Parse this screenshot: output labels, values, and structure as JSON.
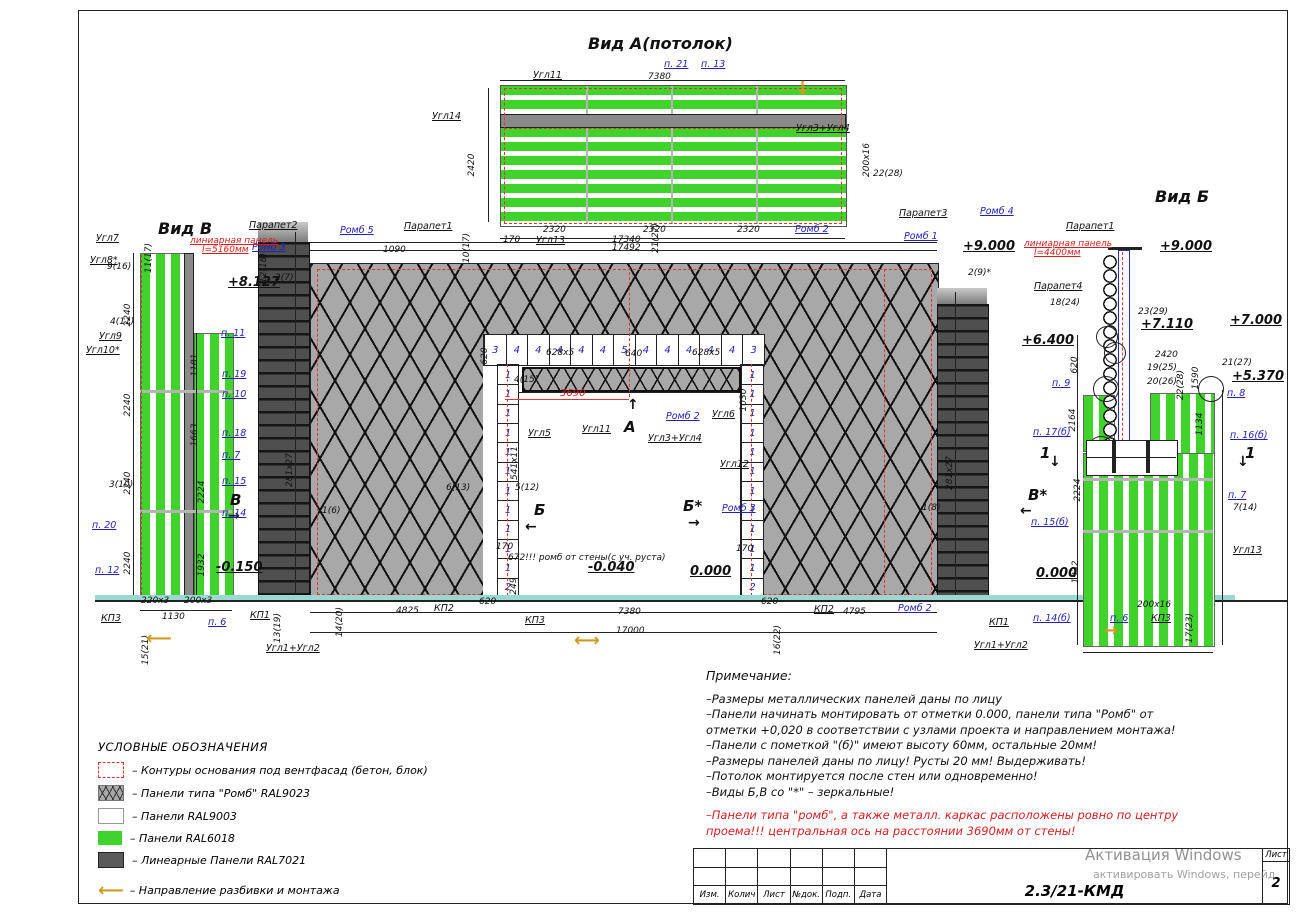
{
  "colors": {
    "green_ral6018": "#3fd32c",
    "gray_ral9023": "#a8a8a8",
    "white_ral9003": "#ffffff",
    "linear_ral7021": "#4f4f4f",
    "contour_red": "#e03535",
    "label_blue": "#2222bb",
    "arrow_orange": "#cf9a20"
  },
  "views": {
    "top_title": "Вид А(потолок)",
    "left_title": "Вид В",
    "right_title": "Вид Б"
  },
  "opening": {
    "top_row": [
      "3",
      "4",
      "4",
      "4",
      "4",
      "4",
      "5",
      "4",
      "4",
      "4",
      "4",
      "4",
      "3"
    ],
    "left_col": [
      "1",
      "1",
      "1",
      "1",
      "1",
      "1",
      "1",
      "1",
      "1",
      "1",
      "1",
      "2"
    ],
    "right_col": [
      "1",
      "1",
      "1",
      "1",
      "1",
      "1",
      "1",
      "1",
      "1",
      "1",
      "1",
      "2"
    ]
  },
  "legend": {
    "title": "УСЛОВНЫЕ ОБОЗНАЧЕНИЯ",
    "items": [
      {
        "swatch": "base",
        "label": "– Контуры основания под вентфасад (бетон, блок)"
      },
      {
        "swatch": "rhomb",
        "label": "– Панели типа \"Ромб\" RAL9023"
      },
      {
        "swatch": "white",
        "label": "– Панели  RAL9003"
      },
      {
        "swatch": "green",
        "label": "– Панели  RAL6018"
      },
      {
        "swatch": "linear",
        "label": "– Линеарные Панели RAL7021"
      }
    ],
    "direction_arrow": "⟵",
    "direction_label": "– Направление разбивки и монтажа"
  },
  "notes": {
    "title": "Примечание:",
    "lines": [
      "–Размеры металлических панелей даны по лицу",
      "–Панели начинать монтировать от отметки 0.000, панели типа \"Ромб\" от",
      "отметки +0,020 в соответствии с узлами проекта и направлением монтажа!",
      "–Панели с пометкой \"(б)\" имеют высоту 60мм, остальные 20мм!",
      "–Размеры панелей даны по лицу! Русты 20 мм! Выдерживать!",
      "–Потолок монтируется после стен или одновременно!",
      "–Виды Б,В со \"*\" – зеркальные!"
    ],
    "red_lines": [
      "–Панели типа \"ромб\", а также металл. каркас расположены ровно по центру",
      "проема!!! центральная ось на расстоянии 3690мм от стены!"
    ]
  },
  "titleblock": {
    "cols": [
      "Изм.",
      "Колич",
      "Лист",
      "№док.",
      "Подп.",
      "Дата"
    ],
    "code": "2.3/21-КМД",
    "sheet_label": "Лист",
    "sheet_num": "2"
  },
  "watermark": {
    "line1": "Активация Windows",
    "line2": "активировать Windows, перейд"
  },
  "annotations": [
    {
      "t": "Вид А(потолок)",
      "x": 588,
      "y": 36,
      "c": "t"
    },
    {
      "t": "Угл11",
      "x": 533,
      "y": 71,
      "c": "k"
    },
    {
      "t": "7380",
      "x": 648,
      "y": 73,
      "c": "d"
    },
    {
      "t": "п. 21",
      "x": 664,
      "y": 60,
      "c": "b"
    },
    {
      "t": "п. 13",
      "x": 701,
      "y": 60,
      "c": "b"
    },
    {
      "t": "↓",
      "x": 795,
      "y": 80,
      "c": "o"
    },
    {
      "t": "Угл14",
      "x": 432,
      "y": 112,
      "c": "k"
    },
    {
      "t": "Угл3+Угл4",
      "x": 796,
      "y": 124,
      "c": "k"
    },
    {
      "t": "2420",
      "x": 468,
      "y": 165,
      "c": "dv"
    },
    {
      "t": "200x16",
      "x": 863,
      "y": 160,
      "c": "dv"
    },
    {
      "t": "22(28)",
      "x": 873,
      "y": 170,
      "c": "d"
    },
    {
      "t": "170",
      "x": 503,
      "y": 236,
      "c": "d"
    },
    {
      "t": "2320",
      "x": 543,
      "y": 226,
      "c": "d"
    },
    {
      "t": "Угл13",
      "x": 536,
      "y": 236,
      "c": "k"
    },
    {
      "t": "2320",
      "x": 643,
      "y": 226,
      "c": "d"
    },
    {
      "t": "21(27)",
      "x": 652,
      "y": 238,
      "c": "dv"
    },
    {
      "t": "2320",
      "x": 737,
      "y": 226,
      "c": "d"
    },
    {
      "t": "17340",
      "x": 612,
      "y": 236,
      "c": "d"
    },
    {
      "t": "17492",
      "x": 612,
      "y": 244,
      "c": "d"
    },
    {
      "t": "Парапет2",
      "x": 249,
      "y": 221,
      "c": "k"
    },
    {
      "t": "Ромб 5",
      "x": 340,
      "y": 226,
      "c": "b"
    },
    {
      "t": "Парапет1",
      "x": 404,
      "y": 222,
      "c": "k"
    },
    {
      "t": "Ромб 3",
      "x": 252,
      "y": 243,
      "c": "b"
    },
    {
      "t": "линиарная панель",
      "x": 190,
      "y": 237,
      "c": "r"
    },
    {
      "t": "l=5160мм",
      "x": 202,
      "y": 246,
      "c": "r"
    },
    {
      "t": "+8.127",
      "x": 228,
      "y": 276,
      "c": "lv"
    },
    {
      "t": "12(18)",
      "x": 260,
      "y": 268,
      "c": "dv"
    },
    {
      "t": "2(7)",
      "x": 275,
      "y": 274,
      "c": "d"
    },
    {
      "t": "1090",
      "x": 383,
      "y": 246,
      "c": "d"
    },
    {
      "t": "10(17)",
      "x": 463,
      "y": 248,
      "c": "dv"
    },
    {
      "t": "Ромб 2",
      "x": 795,
      "y": 225,
      "c": "b"
    },
    {
      "t": "Парапет3",
      "x": 899,
      "y": 209,
      "c": "k"
    },
    {
      "t": "Ромб 4",
      "x": 980,
      "y": 207,
      "c": "b"
    },
    {
      "t": "Ромб 1",
      "x": 904,
      "y": 232,
      "c": "b"
    },
    {
      "t": "+9.000",
      "x": 963,
      "y": 240,
      "c": "lv"
    },
    {
      "t": "2(9)*",
      "x": 968,
      "y": 269,
      "c": "d"
    },
    {
      "t": "линиарная панель",
      "x": 1024,
      "y": 240,
      "c": "r"
    },
    {
      "t": "l=4400мм",
      "x": 1034,
      "y": 249,
      "c": "r"
    },
    {
      "t": "620",
      "x": 481,
      "y": 356,
      "c": "dv"
    },
    {
      "t": "628x5",
      "x": 546,
      "y": 349,
      "c": "d"
    },
    {
      "t": "640",
      "x": 625,
      "y": 350,
      "c": "d"
    },
    {
      "t": "628x5",
      "x": 692,
      "y": 349,
      "c": "d"
    },
    {
      "t": "4(15)",
      "x": 514,
      "y": 376,
      "c": "d"
    },
    {
      "t": "3690",
      "x": 560,
      "y": 389,
      "c": "rd"
    },
    {
      "t": "Ромб 2",
      "x": 666,
      "y": 412,
      "c": "b"
    },
    {
      "t": "Угл6",
      "x": 712,
      "y": 410,
      "c": "k"
    },
    {
      "t": "1030",
      "x": 740,
      "y": 400,
      "c": "dv"
    },
    {
      "t": "↑",
      "x": 627,
      "y": 398,
      "c": "arr"
    },
    {
      "t": "А",
      "x": 624,
      "y": 420,
      "c": "big"
    },
    {
      "t": "Угл11",
      "x": 582,
      "y": 425,
      "c": "k"
    },
    {
      "t": "Угл3+Угл4",
      "x": 648,
      "y": 434,
      "c": "k"
    },
    {
      "t": "Угл5",
      "x": 528,
      "y": 429,
      "c": "k"
    },
    {
      "t": "541x11",
      "x": 511,
      "y": 463,
      "c": "dv"
    },
    {
      "t": "5(12)",
      "x": 515,
      "y": 484,
      "c": "d"
    },
    {
      "t": "Б",
      "x": 534,
      "y": 503,
      "c": "big"
    },
    {
      "t": "←",
      "x": 525,
      "y": 520,
      "c": "arr"
    },
    {
      "t": "Б*",
      "x": 683,
      "y": 499,
      "c": "big"
    },
    {
      "t": "→",
      "x": 688,
      "y": 516,
      "c": "arr"
    },
    {
      "t": "Угл12",
      "x": 720,
      "y": 460,
      "c": "k"
    },
    {
      "t": "Ромб 3",
      "x": 722,
      "y": 504,
      "c": "b"
    },
    {
      "t": "6(13)",
      "x": 446,
      "y": 484,
      "c": "d"
    },
    {
      "t": "1(6)",
      "x": 322,
      "y": 507,
      "c": "d"
    },
    {
      "t": "1(8)",
      "x": 922,
      "y": 504,
      "c": "d"
    },
    {
      "t": "281x27",
      "x": 286,
      "y": 470,
      "c": "dv"
    },
    {
      "t": "281x27",
      "x": 946,
      "y": 473,
      "c": "dv"
    },
    {
      "t": "170",
      "x": 496,
      "y": 543,
      "c": "d"
    },
    {
      "t": "170",
      "x": 736,
      "y": 545,
      "c": "d"
    },
    {
      "t": "672!!! ромб от стены(с уч. руста)",
      "x": 508,
      "y": 554,
      "c": "d"
    },
    {
      "t": "-0.040",
      "x": 588,
      "y": 561,
      "c": "lv"
    },
    {
      "t": "0.000",
      "x": 690,
      "y": 565,
      "c": "lv"
    },
    {
      "t": "249",
      "x": 510,
      "y": 586,
      "c": "dv"
    },
    {
      "t": "-0.150",
      "x": 216,
      "y": 561,
      "c": "lv"
    },
    {
      "t": "14(20)",
      "x": 336,
      "y": 622,
      "c": "dv"
    },
    {
      "t": "4825",
      "x": 396,
      "y": 607,
      "c": "d"
    },
    {
      "t": "КП2",
      "x": 434,
      "y": 604,
      "c": "k"
    },
    {
      "t": "620",
      "x": 479,
      "y": 598,
      "c": "d"
    },
    {
      "t": "КП3",
      "x": 525,
      "y": 616,
      "c": "k"
    },
    {
      "t": "7380",
      "x": 618,
      "y": 608,
      "c": "d"
    },
    {
      "t": "17000",
      "x": 616,
      "y": 627,
      "c": "d"
    },
    {
      "t": "⟷",
      "x": 574,
      "y": 632,
      "c": "o"
    },
    {
      "t": "620",
      "x": 761,
      "y": 598,
      "c": "d"
    },
    {
      "t": "16(22)",
      "x": 774,
      "y": 640,
      "c": "dv"
    },
    {
      "t": "КП2",
      "x": 814,
      "y": 605,
      "c": "k"
    },
    {
      "t": "4795",
      "x": 843,
      "y": 608,
      "c": "d"
    },
    {
      "t": "Ромб 2",
      "x": 898,
      "y": 604,
      "c": "b"
    },
    {
      "t": "КП1",
      "x": 989,
      "y": 618,
      "c": "k"
    },
    {
      "t": "Угл1+Угл2",
      "x": 974,
      "y": 641,
      "c": "k"
    },
    {
      "t": "Вид В",
      "x": 158,
      "y": 221,
      "c": "t"
    },
    {
      "t": "Угл7",
      "x": 96,
      "y": 234,
      "c": "k"
    },
    {
      "t": "11(17)",
      "x": 145,
      "y": 258,
      "c": "dv"
    },
    {
      "t": "Угл8*",
      "x": 90,
      "y": 256,
      "c": "k"
    },
    {
      "t": "9(16)",
      "x": 107,
      "y": 263,
      "c": "d"
    },
    {
      "t": "2240",
      "x": 124,
      "y": 315,
      "c": "dv"
    },
    {
      "t": "4(11)",
      "x": 110,
      "y": 318,
      "c": "d"
    },
    {
      "t": "Угл9",
      "x": 99,
      "y": 332,
      "c": "k"
    },
    {
      "t": "Угл10*",
      "x": 86,
      "y": 346,
      "c": "k"
    },
    {
      "t": "2240",
      "x": 124,
      "y": 405,
      "c": "dv"
    },
    {
      "t": "2240",
      "x": 124,
      "y": 483,
      "c": "dv"
    },
    {
      "t": "2240",
      "x": 124,
      "y": 563,
      "c": "dv"
    },
    {
      "t": "3(10)",
      "x": 109,
      "y": 481,
      "c": "d"
    },
    {
      "t": "п. 20",
      "x": 92,
      "y": 521,
      "c": "b"
    },
    {
      "t": "п. 12",
      "x": 95,
      "y": 566,
      "c": "b"
    },
    {
      "t": "п. 11",
      "x": 221,
      "y": 329,
      "c": "b"
    },
    {
      "t": "1181",
      "x": 191,
      "y": 365,
      "c": "dv"
    },
    {
      "t": "п. 19",
      "x": 222,
      "y": 370,
      "c": "b"
    },
    {
      "t": "п. 10",
      "x": 222,
      "y": 390,
      "c": "b"
    },
    {
      "t": "1663",
      "x": 191,
      "y": 435,
      "c": "dv"
    },
    {
      "t": "п. 18",
      "x": 222,
      "y": 429,
      "c": "b"
    },
    {
      "t": "п. 7",
      "x": 222,
      "y": 451,
      "c": "b"
    },
    {
      "t": "2224",
      "x": 198,
      "y": 492,
      "c": "dv"
    },
    {
      "t": "п. 15",
      "x": 222,
      "y": 477,
      "c": "b"
    },
    {
      "t": "B",
      "x": 230,
      "y": 493,
      "c": "big"
    },
    {
      "t": "→",
      "x": 228,
      "y": 509,
      "c": "arr"
    },
    {
      "t": "п. 14",
      "x": 222,
      "y": 509,
      "c": "b"
    },
    {
      "t": "1932",
      "x": 198,
      "y": 565,
      "c": "dv"
    },
    {
      "t": "КП3",
      "x": 101,
      "y": 614,
      "c": "k"
    },
    {
      "t": "220x3",
      "x": 141,
      "y": 597,
      "c": "d"
    },
    {
      "t": "200x3",
      "x": 184,
      "y": 597,
      "c": "d"
    },
    {
      "t": "1130",
      "x": 162,
      "y": 613,
      "c": "d"
    },
    {
      "t": "15(21)",
      "x": 142,
      "y": 650,
      "c": "dv"
    },
    {
      "t": "⟵",
      "x": 146,
      "y": 630,
      "c": "o"
    },
    {
      "t": "п. 6",
      "x": 208,
      "y": 618,
      "c": "b"
    },
    {
      "t": "КП1",
      "x": 250,
      "y": 611,
      "c": "k"
    },
    {
      "t": "13(19)",
      "x": 274,
      "y": 628,
      "c": "dv"
    },
    {
      "t": "Угл1+Угл2",
      "x": 266,
      "y": 644,
      "c": "k"
    },
    {
      "t": "Вид Б",
      "x": 1155,
      "y": 189,
      "c": "t"
    },
    {
      "t": "Парапет1",
      "x": 1066,
      "y": 222,
      "c": "k"
    },
    {
      "t": "+9.000",
      "x": 1160,
      "y": 240,
      "c": "lv"
    },
    {
      "t": "Парапет4",
      "x": 1034,
      "y": 282,
      "c": "k"
    },
    {
      "t": "18(24)",
      "x": 1050,
      "y": 299,
      "c": "d"
    },
    {
      "t": "23(29)",
      "x": 1138,
      "y": 308,
      "c": "d"
    },
    {
      "t": "+7.110",
      "x": 1141,
      "y": 318,
      "c": "lv"
    },
    {
      "t": "+7.000",
      "x": 1230,
      "y": 314,
      "c": "lv"
    },
    {
      "t": "+6.400",
      "x": 1022,
      "y": 334,
      "c": "lv"
    },
    {
      "t": "620",
      "x": 1071,
      "y": 365,
      "c": "dv"
    },
    {
      "t": "п. 9",
      "x": 1052,
      "y": 379,
      "c": "b"
    },
    {
      "t": "2164",
      "x": 1069,
      "y": 420,
      "c": "dv"
    },
    {
      "t": "2420",
      "x": 1155,
      "y": 351,
      "c": "d"
    },
    {
      "t": "19(25)",
      "x": 1147,
      "y": 364,
      "c": "d"
    },
    {
      "t": "22(28)",
      "x": 1177,
      "y": 385,
      "c": "dv"
    },
    {
      "t": "1590",
      "x": 1192,
      "y": 378,
      "c": "dv"
    },
    {
      "t": "20(26)",
      "x": 1147,
      "y": 378,
      "c": "d"
    },
    {
      "t": "21(27)",
      "x": 1222,
      "y": 359,
      "c": "d"
    },
    {
      "t": "+5.370",
      "x": 1232,
      "y": 370,
      "c": "lv"
    },
    {
      "t": "п. 8",
      "x": 1227,
      "y": 389,
      "c": "b"
    },
    {
      "t": "1134",
      "x": 1196,
      "y": 424,
      "c": "dv"
    },
    {
      "t": "п. 16(б)",
      "x": 1230,
      "y": 431,
      "c": "b"
    },
    {
      "t": "1",
      "x": 1040,
      "y": 446,
      "c": "big"
    },
    {
      "t": "↓",
      "x": 1049,
      "y": 455,
      "c": "arr"
    },
    {
      "t": "1",
      "x": 1245,
      "y": 446,
      "c": "big"
    },
    {
      "t": "↓",
      "x": 1237,
      "y": 455,
      "c": "arr"
    },
    {
      "t": "п. 17(б)",
      "x": 1033,
      "y": 428,
      "c": "b"
    },
    {
      "t": "2224",
      "x": 1074,
      "y": 490,
      "c": "dv"
    },
    {
      "t": "B*",
      "x": 1028,
      "y": 488,
      "c": "big"
    },
    {
      "t": "←",
      "x": 1020,
      "y": 504,
      "c": "arr"
    },
    {
      "t": "п. 15(б)",
      "x": 1031,
      "y": 518,
      "c": "b"
    },
    {
      "t": "п. 7",
      "x": 1228,
      "y": 491,
      "c": "b"
    },
    {
      "t": "7(14)",
      "x": 1233,
      "y": 504,
      "c": "d"
    },
    {
      "t": "Угл13",
      "x": 1233,
      "y": 546,
      "c": "k"
    },
    {
      "t": "1932",
      "x": 1072,
      "y": 572,
      "c": "dv"
    },
    {
      "t": "0.000",
      "x": 1036,
      "y": 567,
      "c": "lv"
    },
    {
      "t": "п. 14(б)",
      "x": 1033,
      "y": 614,
      "c": "b"
    },
    {
      "t": "п. 6",
      "x": 1110,
      "y": 614,
      "c": "b"
    },
    {
      "t": "200x16",
      "x": 1137,
      "y": 601,
      "c": "d"
    },
    {
      "t": "КП3",
      "x": 1151,
      "y": 614,
      "c": "k"
    },
    {
      "t": "17(23)",
      "x": 1186,
      "y": 628,
      "c": "dv"
    },
    {
      "t": "→",
      "x": 1103,
      "y": 622,
      "c": "o"
    }
  ]
}
